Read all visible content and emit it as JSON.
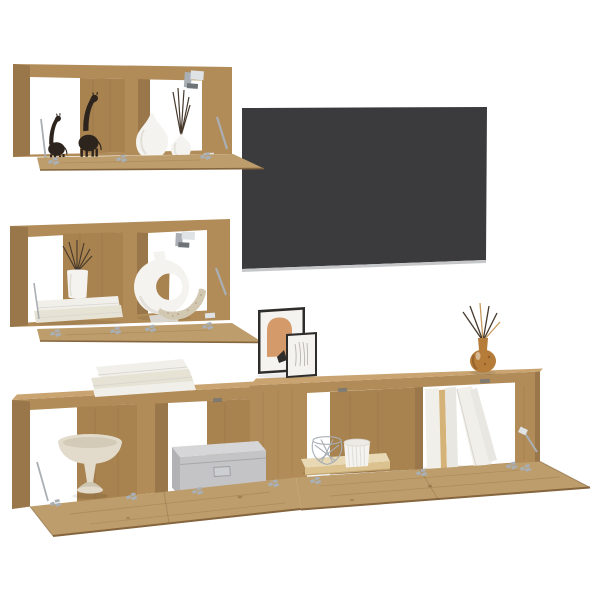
{
  "scene": {
    "type": "product-photo",
    "subject": "5-piece wall-mounted TV media wall set, artisan oak, open drop-down flap doors, styled with decor and a flat-screen TV",
    "background": "#ffffff"
  },
  "colors": {
    "wall_white": "#ffffff",
    "wood": "#b28c58",
    "wood_top": "#c9a471",
    "wood_light": "#bd9d6b",
    "wood_side": "#9a774a",
    "wood_back": "#a8824f",
    "wood_edge": "#85653d",
    "grain": "#8a6a40",
    "tv_screen": "#3b3b3d",
    "tv_bezel": "#c6c7c9",
    "metal": "#a9afb4",
    "metal_light": "#dfe3e5",
    "metal_dark": "#6f7478",
    "figurine_black": "#2c241d",
    "ceramic_white": "#f4f3ef",
    "ceramic_shade": "#d9d6cf",
    "book_white": "#f1efe9",
    "book_cream": "#e6e2d4",
    "book_shaded": "#e9e7e1",
    "book_tan": "#d5b277",
    "storage_gray": "#c4c4c6",
    "storage_gray_top": "#d6d6d8",
    "storage_gray_side": "#b2b2b5",
    "bowl_cream": "#e2dbcb",
    "bowl_shade": "#cfc6b2",
    "plank_top": "#e8d9b4",
    "plank_light": "#dcc28e",
    "plank_edge": "#c3a876",
    "sculpture_beige": "#d2c8b2",
    "speckle": "#a6987b",
    "art_terracotta": "#d49a6a",
    "frame_black": "#2f2d2b",
    "sketch_gray": "#b9b6b0",
    "diffuser_amber": "#b57c3a",
    "diffuser_dark": "#8a5a26",
    "stick_dark": "#46392c",
    "stick_tan": "#c79a5d"
  },
  "furniture": {
    "top_cabinet": {
      "label": "wall cabinet with open flap door",
      "decor": [
        "black giraffe figurine small",
        "black giraffe figurine large",
        "white teardrop vase",
        "white reed-diffuser vase"
      ]
    },
    "middle_cabinet": {
      "label": "wall cabinet with open flap door",
      "decor": [
        "white book stack",
        "white vase with reed sticks",
        "white ring vase",
        "beige textured sculpture"
      ]
    },
    "tv": {
      "label": "wall-mounted flat-screen TV"
    },
    "stand_left": {
      "label": "low TV cabinet with two open compartments",
      "decor": [
        "book stack on top",
        "cream pedestal bowl",
        "gray fabric storage box"
      ]
    },
    "stand_right": {
      "label": "raised TV cabinet with two open compartments",
      "decor": [
        "two picture frames",
        "amber reed diffuser",
        "wire basket",
        "ribbed white pot",
        "light wood plank",
        "upright books"
      ]
    },
    "hardware": [
      "door hinges",
      "flap stay arms",
      "wall-mount brackets"
    ]
  }
}
